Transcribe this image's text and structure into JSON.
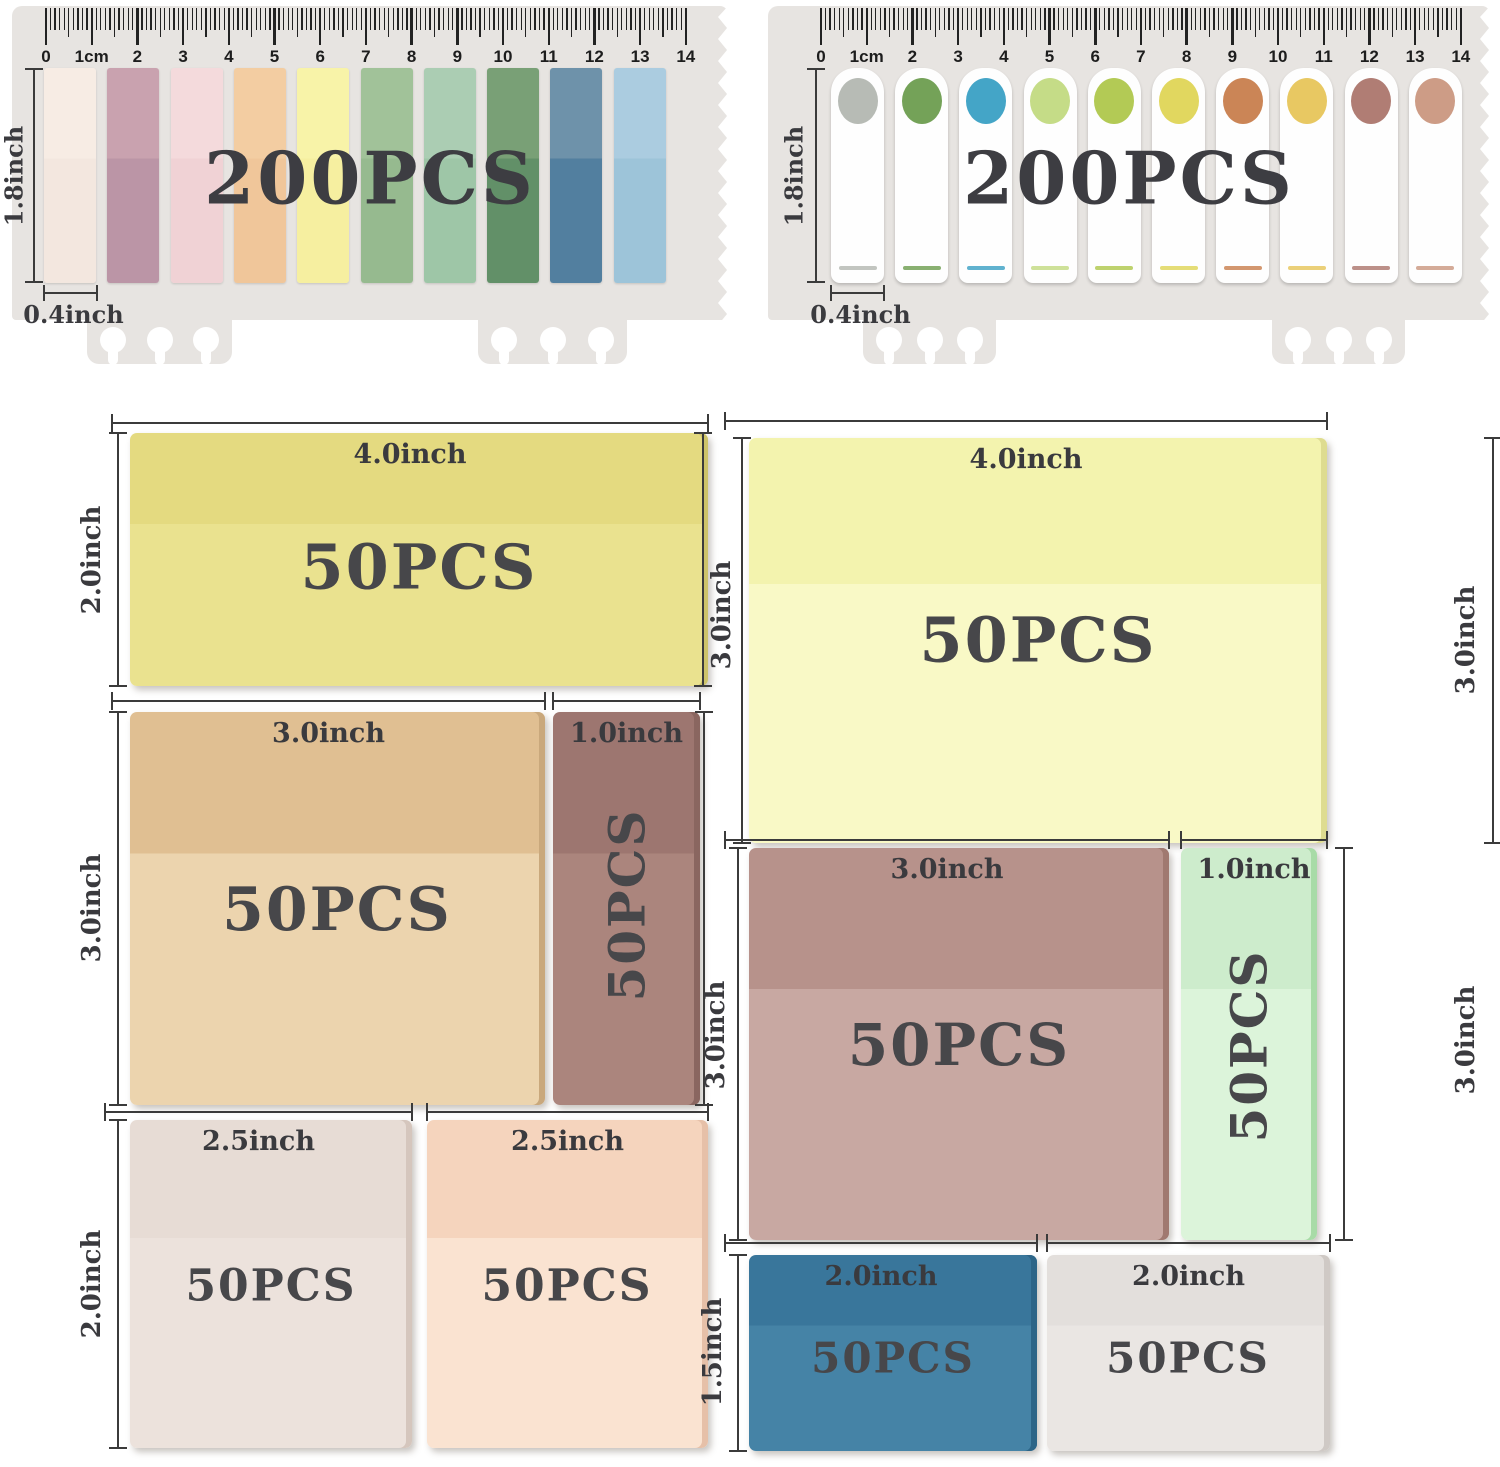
{
  "ink_color": "#3b3b3b",
  "card_color": "#e7e4e1",
  "rulers": [
    {
      "id": "left",
      "pcs_text": "200PCS",
      "height_label": "1.8inch",
      "width_label": "0.4inch",
      "scale_numbers": [
        "0",
        "1cm",
        "2",
        "3",
        "4",
        "5",
        "6",
        "7",
        "8",
        "9",
        "10",
        "11",
        "12",
        "13",
        "14"
      ],
      "tab_style": "strip",
      "tabs": [
        {
          "name": "cream",
          "top": "#f7ece4",
          "bottom": "#f3e7df"
        },
        {
          "name": "mauve",
          "top": "#c9a2af",
          "bottom": "#bb95a6"
        },
        {
          "name": "light-pink",
          "top": "#f4dadc",
          "bottom": "#f0d2d5"
        },
        {
          "name": "peach",
          "top": "#f3cda2",
          "bottom": "#f0c69a"
        },
        {
          "name": "pale-yellow",
          "top": "#f8f3a8",
          "bottom": "#f6efa0"
        },
        {
          "name": "sage-green",
          "top": "#a1c299",
          "bottom": "#96ba8f"
        },
        {
          "name": "mint-green",
          "top": "#abcdb3",
          "bottom": "#9ec6a7"
        },
        {
          "name": "forest-green",
          "top": "#79a076",
          "bottom": "#629068"
        },
        {
          "name": "steel-blue",
          "top": "#6e92aa",
          "bottom": "#527f9f"
        },
        {
          "name": "light-blue",
          "top": "#abcce0",
          "bottom": "#9dc4d9"
        }
      ]
    },
    {
      "id": "right",
      "pcs_text": "200PCS",
      "height_label": "1.8inch",
      "width_label": "0.4inch",
      "scale_numbers": [
        "0",
        "1cm",
        "2",
        "3",
        "4",
        "5",
        "6",
        "7",
        "8",
        "9",
        "10",
        "11",
        "12",
        "13",
        "14"
      ],
      "tab_style": "flag",
      "tabs": [
        {
          "name": "gray",
          "dot": "#b7bbb5"
        },
        {
          "name": "green",
          "dot": "#74a258"
        },
        {
          "name": "teal-blue",
          "dot": "#44a5c7"
        },
        {
          "name": "light-yellow-green",
          "dot": "#c5dc87"
        },
        {
          "name": "yellow-green",
          "dot": "#b3ca55"
        },
        {
          "name": "yellow",
          "dot": "#e1d75f"
        },
        {
          "name": "terracotta",
          "dot": "#cb8556"
        },
        {
          "name": "golden-yellow",
          "dot": "#e8c862"
        },
        {
          "name": "rosy-brown",
          "dot": "#b07d74"
        },
        {
          "name": "dusty-pink",
          "dot": "#cd9c86"
        }
      ]
    }
  ],
  "notes": [
    {
      "id": "L1",
      "name": "yellow-note",
      "pcs": "50PCS",
      "width_label": "4.0inch",
      "height_label": "2.0inch",
      "color_top": "#e4da80",
      "color_bottom": "#eae28f",
      "edge": "#cdc369"
    },
    {
      "id": "L2",
      "name": "tan-note",
      "pcs": "50PCS",
      "width_label": "3.0inch",
      "height_label": "3.0inch",
      "color_top": "#e0bf92",
      "color_bottom": "#ecd4ae",
      "edge": "#c9a87c"
    },
    {
      "id": "L3",
      "name": "mauve-brown-note",
      "pcs": "50PCS",
      "width_label": "1.0inch",
      "color_top": "#9d7670",
      "color_bottom": "#ab857d",
      "edge": "#8a6660",
      "pcs_vertical": true
    },
    {
      "id": "L4",
      "name": "blush-note",
      "pcs": "50PCS",
      "width_label": "2.5inch",
      "height_label": "2.0inch",
      "color_top": "#e7dcd5",
      "color_bottom": "#ece2dc",
      "edge": "#d5c6bd"
    },
    {
      "id": "L5",
      "name": "peach-pink-note",
      "pcs": "50PCS",
      "width_label": "2.5inch",
      "color_top": "#f5d4bd",
      "color_bottom": "#fae3d1",
      "edge": "#e6c0a8"
    },
    {
      "id": "R1",
      "name": "pale-yellow-note",
      "pcs": "50PCS",
      "width_label": "4.0inch",
      "height_label": "3.0inch",
      "height_label_right": "3.0inch",
      "color_top": "#f3f3ae",
      "color_bottom": "#f9f9c6",
      "edge": "#dedc90"
    },
    {
      "id": "R2",
      "name": "rosy-mauve-note",
      "pcs": "50PCS",
      "width_label": "3.0inch",
      "height_label": "3.0inch",
      "color_top": "#b7928b",
      "color_bottom": "#c8a8a2",
      "edge": "#a07970"
    },
    {
      "id": "R3",
      "name": "mint-note",
      "pcs": "50PCS",
      "width_label": "1.0inch",
      "height_label_right": "3.0inch",
      "color_top": "#cdeccc",
      "color_bottom": "#dcf4da",
      "edge": "#a8dba7",
      "pcs_vertical": true
    },
    {
      "id": "R4",
      "name": "blue-note",
      "pcs": "50PCS",
      "width_label": "2.0inch",
      "height_label": "1.5inch",
      "color_top": "#39769b",
      "color_bottom": "#4583a6",
      "edge": "#2d6587"
    },
    {
      "id": "R5",
      "name": "off-white-note",
      "pcs": "50PCS",
      "width_label": "2.0inch",
      "color_top": "#e3dfdc",
      "color_bottom": "#eae6e3",
      "edge": "#cfc9c5"
    }
  ]
}
